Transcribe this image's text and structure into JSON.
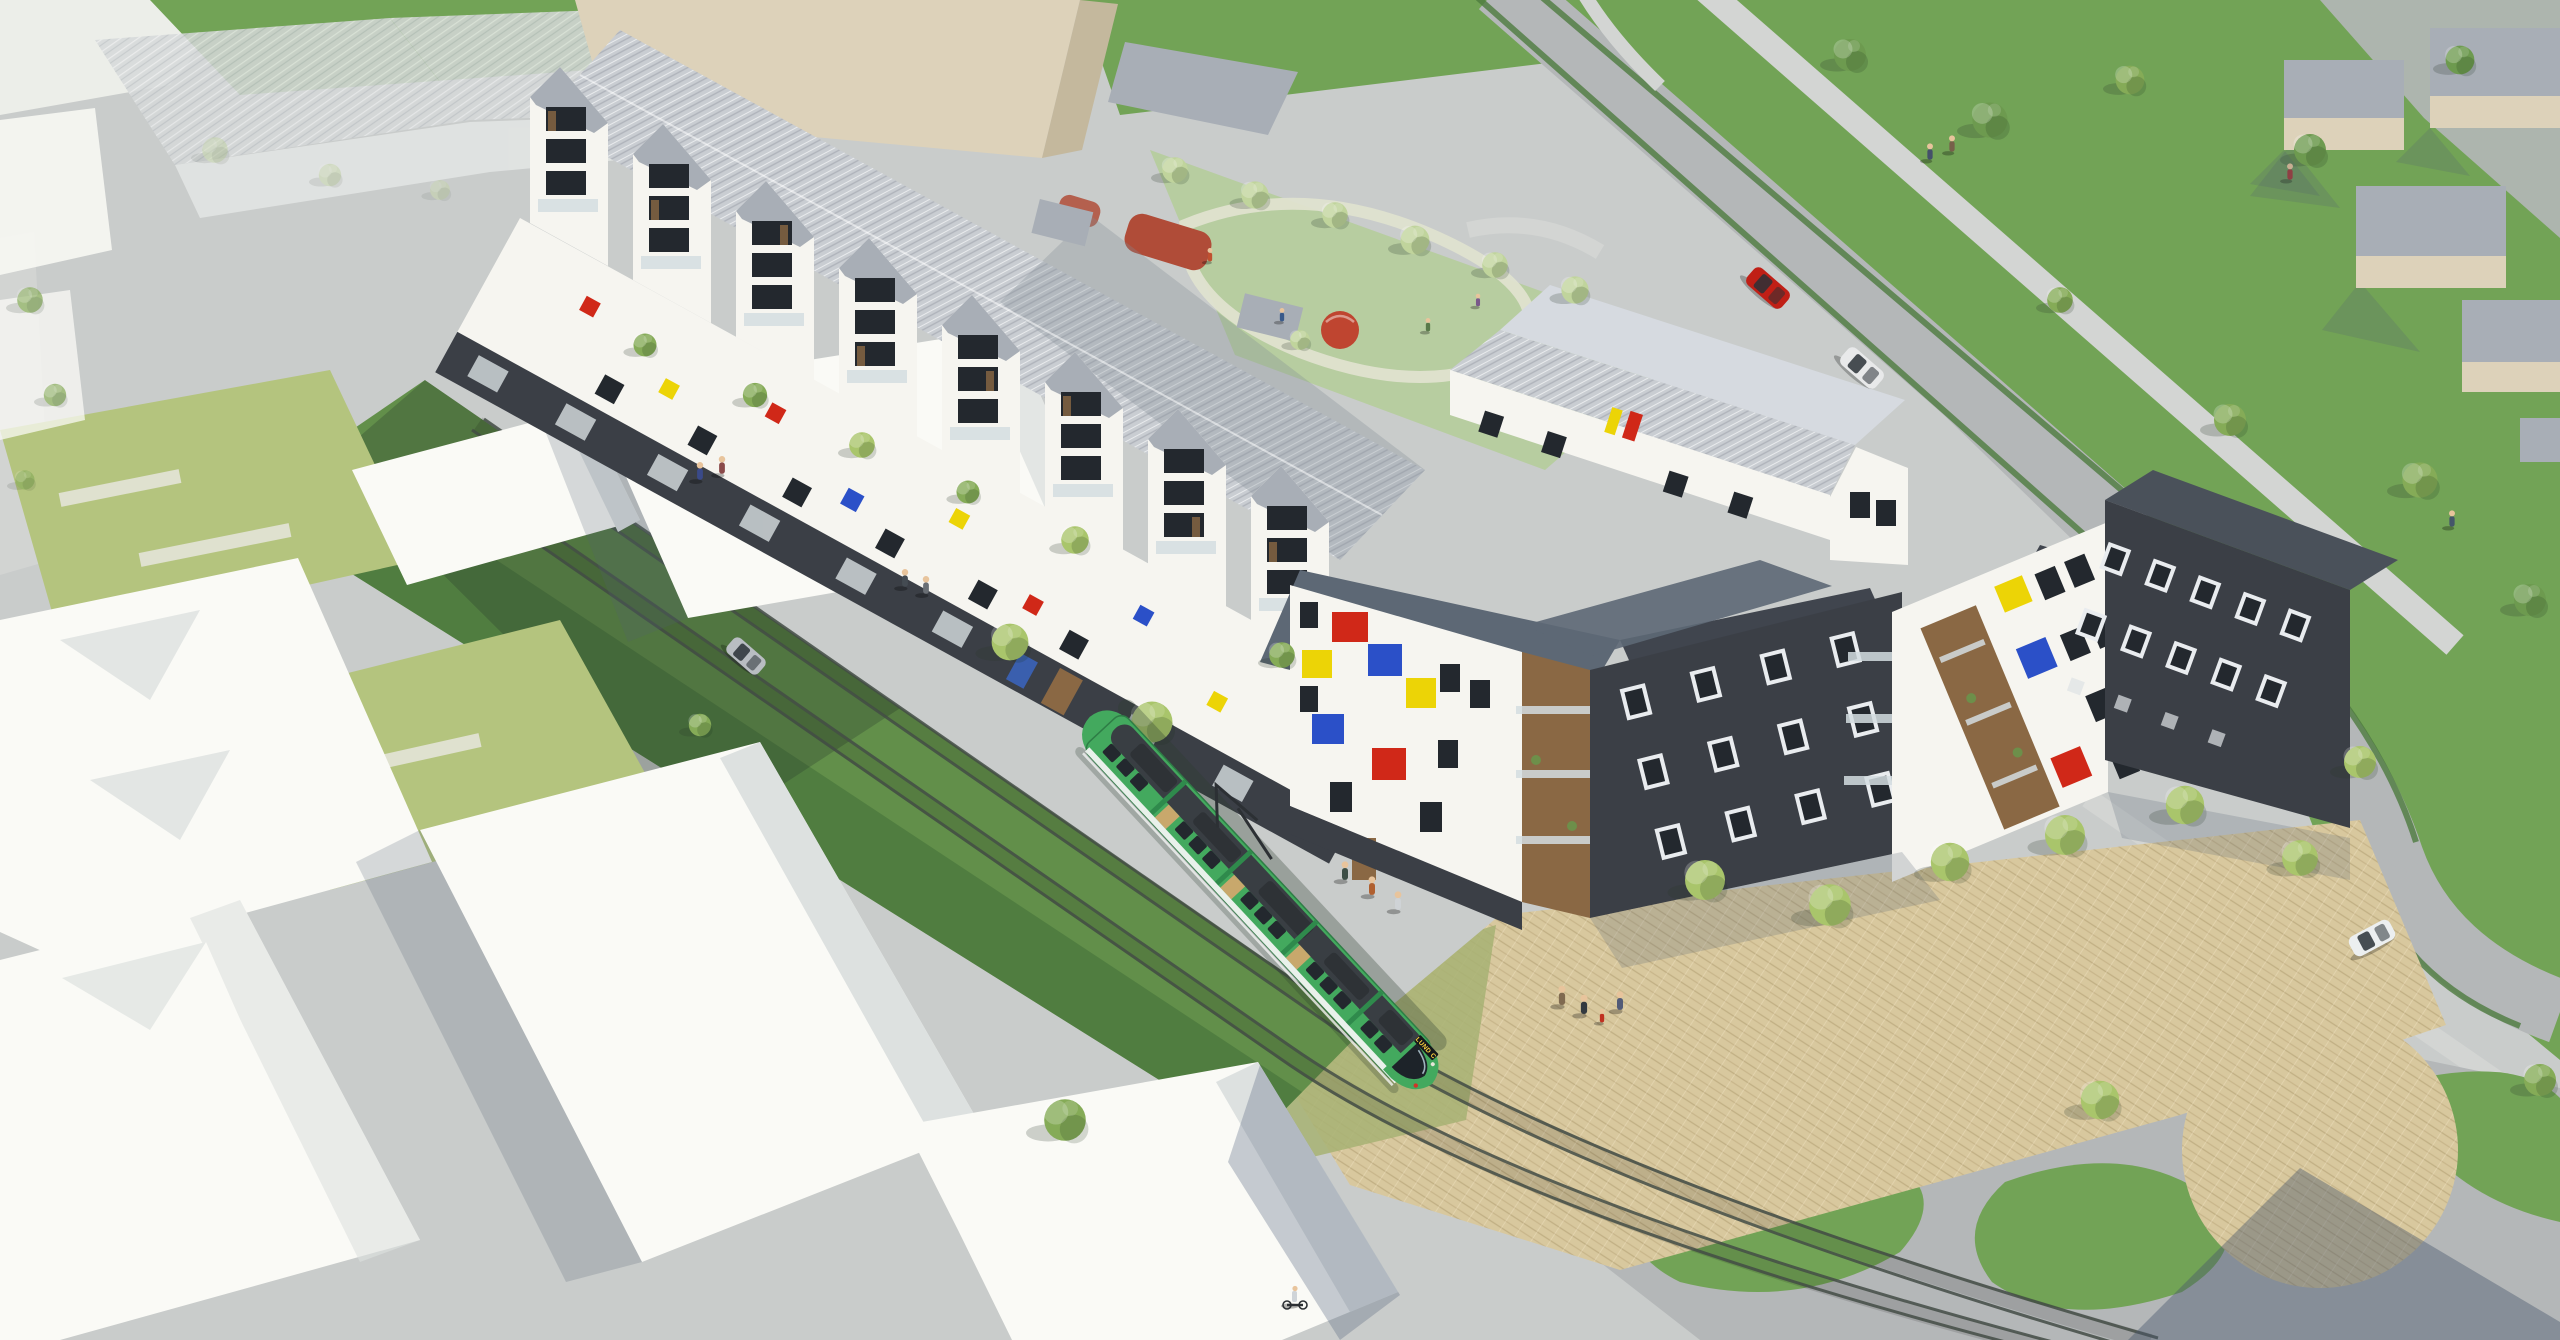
{
  "image": {
    "type": "aerial architectural rendering",
    "subject": "new residential block with grass-track tramway, courtyard playground and surrounding context massing"
  },
  "tram": {
    "destination": "LUND C"
  },
  "colors": {
    "street": "#b4b7b8",
    "sidewalk": "#c9cccb",
    "pathLight": "#d3d5d3",
    "grass": "#72a356",
    "grassShade": "#628f4a",
    "grassDark": "#4d7a3e",
    "lawnPale": "#b7cda0",
    "courtyardGreen": "#b4c47e",
    "courtyardPath": "#dfe1cf",
    "paving": "#d8c89e",
    "pavingGreen": "#a7b273",
    "roofLight": "#c9cdd2",
    "roofMid": "#a8aeb6",
    "roofDark": "#5d6875",
    "roofCharcoal": "#40454e",
    "facadeWhite": "#f6f5f0",
    "facadeShade": "#e4e3db",
    "massWhite": "#fafaf6",
    "massShade": "#dde1e0",
    "darkBrick": "#3b3f46",
    "wood": "#8a6844",
    "beigeFace": "#ddd2ba",
    "beigeSide": "#c4b89d",
    "ghost": "#d6d9da",
    "tramGreen": "#43a95e",
    "tramRoof": "#393e43",
    "accentRed": "#d02818",
    "accentYellow": "#ecd406",
    "accentBlue": "#2b50c8",
    "carRed": "#c01f16",
    "railDark": "#434c45",
    "glass": "#d3dde1",
    "windowDark": "#23282e",
    "treeBright": "#a9c56b",
    "treeMid": "#85ab57",
    "treeDark": "#6d9a4f",
    "treePale": "#c0d49c",
    "skyFade": "#eceee9"
  },
  "inventory": {
    "main_building": "long 4-storey white apartment building, gabled balcony bays, dark ground floor, red/yellow/blue accent panels, standing-seam roof",
    "corner_building": "white corner block with Mondrian-style colour panels and wooden balcony recesses",
    "dark_building": "charcoal brick wings with white-framed windows",
    "north_wing": "low white gabled wing with metal roof",
    "tram": "green low-floor tram on green grass track, destination LUND C",
    "playground": "courtyard playground with red safety surfacing, climbing dome and playhouse",
    "context": "white and beige untextured massing blocks, ghosted industrial hall",
    "vehicles": [
      "red car",
      "silver car",
      "white hatchback",
      "parked grey car"
    ],
    "people_count_approx": 20,
    "trees_count_approx": 40
  }
}
